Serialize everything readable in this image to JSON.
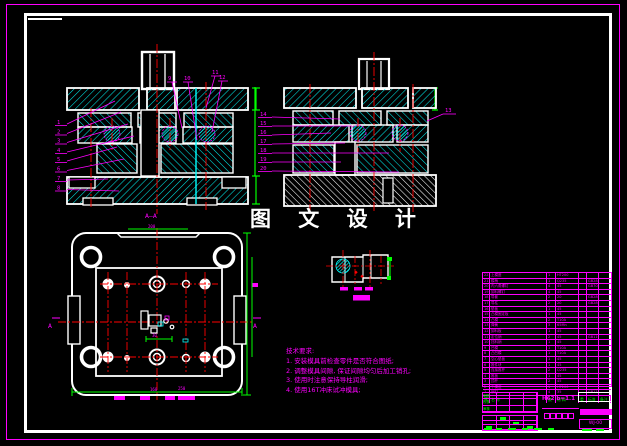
{
  "watermark": {
    "title": "图 文 设 计"
  },
  "section_labels": {
    "left_view": "A—A",
    "plan_marker": "A"
  },
  "balloons": {
    "left": [
      "1",
      "2",
      "3",
      "4",
      "5",
      "6",
      "7",
      "8"
    ],
    "top": [
      "9",
      "10",
      "11",
      "12"
    ],
    "right": [
      "13"
    ],
    "middle": [
      "14",
      "15",
      "16",
      "17",
      "18",
      "19",
      "20"
    ]
  },
  "dimensions": {
    "plan_top": "200",
    "plan_bottom": "250",
    "plan_bottom2": "160",
    "plan_cavity": "30"
  },
  "notes": {
    "title": "技术要求:",
    "items": [
      "1. 安装模具前检查零件是否符合图纸;",
      "2. 调整模具间隙, 保证间隙均匀后加工销孔;",
      "3. 使用时注意保持导柱润滑;",
      "4. 使用16T冲床试冲模具;"
    ]
  },
  "bom": {
    "col_keys": [
      "no",
      "name",
      "qty",
      "material",
      "unit",
      "std",
      "remark"
    ],
    "headers": [
      "序",
      "名  称",
      "数",
      "材 料",
      "重",
      "标准",
      "备注"
    ],
    "rows": [
      {
        "no": "22",
        "name": "上模座",
        "qty": "1",
        "material": "HT200",
        "unit": "",
        "std": "",
        "remark": ""
      },
      {
        "no": "21",
        "name": "模柄",
        "qty": "1",
        "material": "Q235",
        "unit": "",
        "std": "GB2862",
        "remark": ""
      },
      {
        "no": "20",
        "name": "内六角螺钉",
        "qty": "4",
        "material": "45",
        "unit": "",
        "std": "GB70-85",
        "remark": ""
      },
      {
        "no": "19",
        "name": "卸料螺钉",
        "qty": "4",
        "material": "45",
        "unit": "",
        "std": "",
        "remark": ""
      },
      {
        "no": "18",
        "name": "导套",
        "qty": "2",
        "material": "20",
        "unit": "",
        "std": "GB2861",
        "remark": ""
      },
      {
        "no": "17",
        "name": "导柱",
        "qty": "2",
        "material": "20",
        "unit": "",
        "std": "GB2861",
        "remark": ""
      },
      {
        "no": "16",
        "name": "垫板",
        "qty": "1",
        "material": "45",
        "unit": "",
        "std": "",
        "remark": ""
      },
      {
        "no": "15",
        "name": "凸模固定板",
        "qty": "1",
        "material": "45",
        "unit": "",
        "std": "",
        "remark": ""
      },
      {
        "no": "14",
        "name": "凸模",
        "qty": "2",
        "material": "T10A",
        "unit": "",
        "std": "",
        "remark": ""
      },
      {
        "no": "13",
        "name": "弹簧",
        "qty": "3",
        "material": "65Mn",
        "unit": "",
        "std": "",
        "remark": ""
      },
      {
        "no": "12",
        "name": "卸料板",
        "qty": "1",
        "material": "45",
        "unit": "",
        "std": "",
        "remark": ""
      },
      {
        "no": "11",
        "name": "定位销",
        "qty": "2",
        "material": "45",
        "unit": "",
        "std": "GB119-86",
        "remark": ""
      },
      {
        "no": "10",
        "name": "挡料销",
        "qty": "1",
        "material": "45",
        "unit": "",
        "std": "",
        "remark": ""
      },
      {
        "no": "9",
        "name": "凹模",
        "qty": "1",
        "material": "T10A",
        "unit": "",
        "std": "",
        "remark": ""
      },
      {
        "no": "8",
        "name": "凸凹模",
        "qty": "1",
        "material": "T10A",
        "unit": "",
        "std": "",
        "remark": ""
      },
      {
        "no": "7",
        "name": "空心垫板",
        "qty": "1",
        "material": "45",
        "unit": "",
        "std": "",
        "remark": ""
      },
      {
        "no": "6",
        "name": "推件块",
        "qty": "1",
        "material": "45",
        "unit": "",
        "std": "",
        "remark": ""
      },
      {
        "no": "5",
        "name": "连接推杆",
        "qty": "2",
        "material": "Q235",
        "unit": "",
        "std": "",
        "remark": ""
      },
      {
        "no": "4",
        "name": "推板",
        "qty": "1",
        "material": "45",
        "unit": "",
        "std": "",
        "remark": ""
      },
      {
        "no": "3",
        "name": "顶杆",
        "qty": "2",
        "material": "45",
        "unit": "",
        "std": "",
        "remark": ""
      },
      {
        "no": "2",
        "name": "下模座",
        "qty": "1",
        "material": "HT200",
        "unit": "",
        "std": "",
        "remark": ""
      },
      {
        "no": "1",
        "name": "销钉",
        "qty": "4",
        "material": "35",
        "unit": "",
        "std": "GB119-86",
        "remark": ""
      }
    ]
  },
  "title_block": {
    "material": "H62 b=1.1",
    "drawing_no": "WJ-00",
    "sig_labels": [
      "制图",
      "校核",
      "审核"
    ]
  }
}
